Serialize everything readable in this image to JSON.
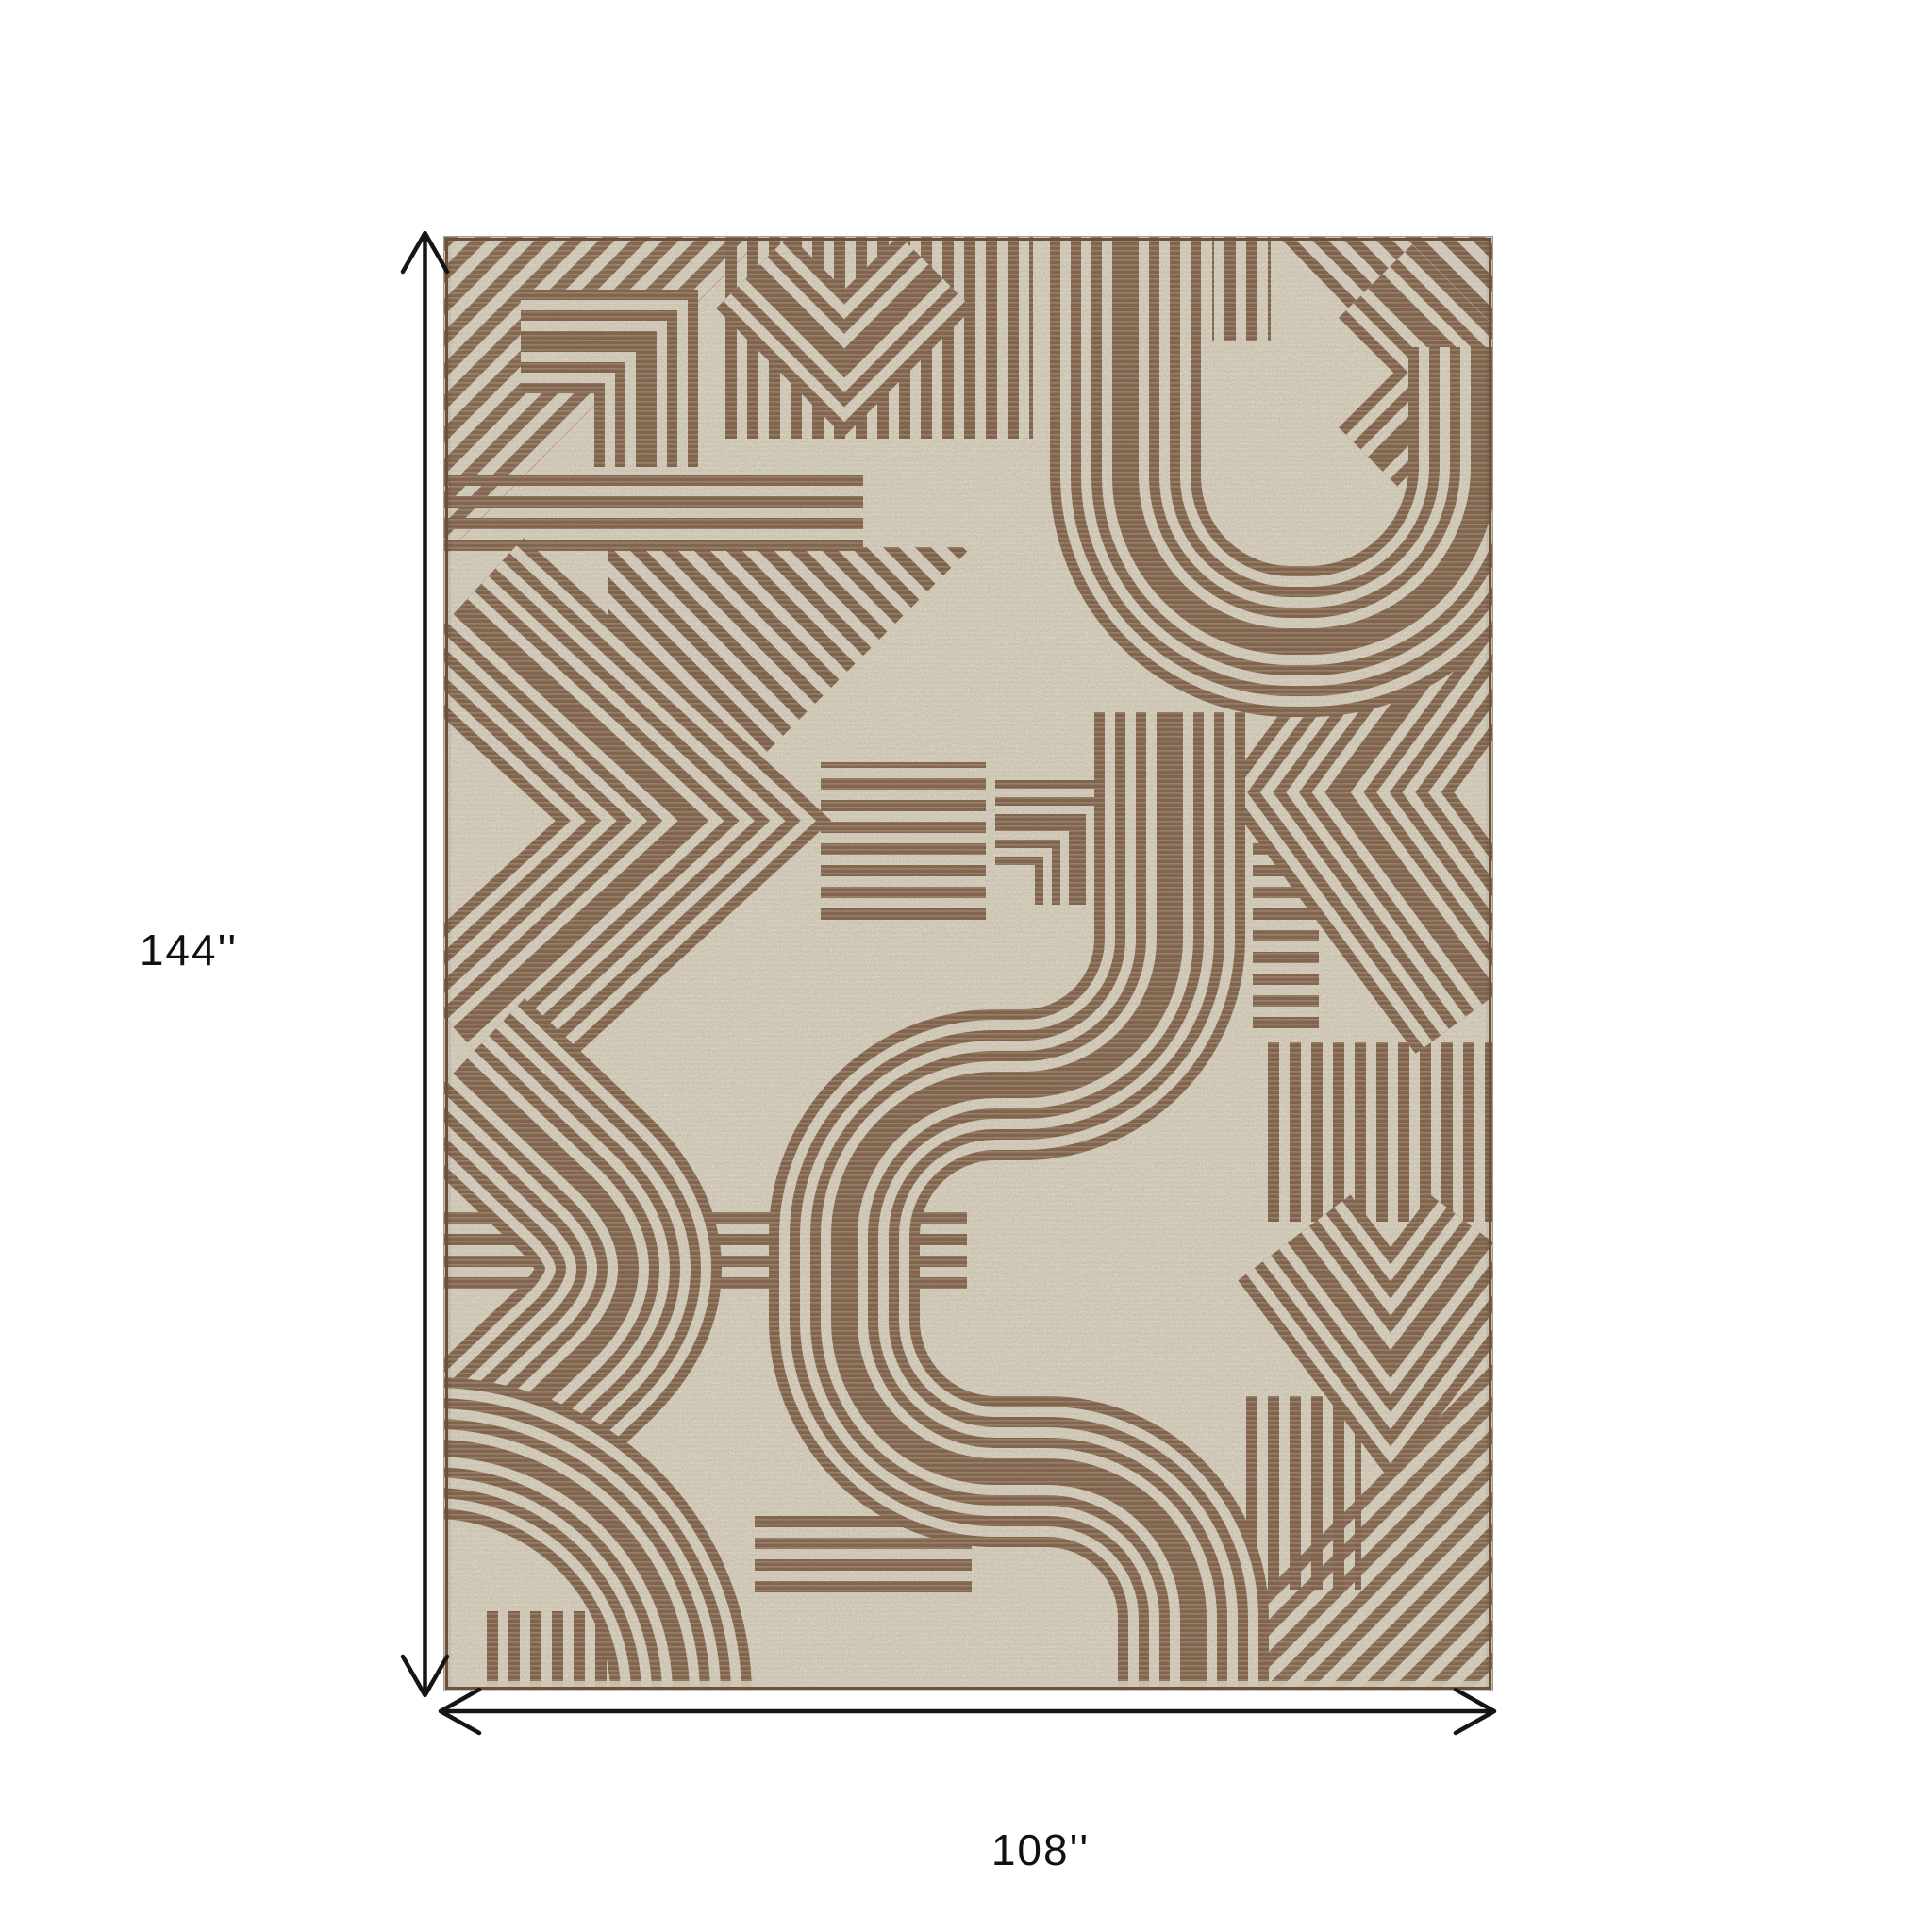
{
  "diagram": {
    "type": "product-dimension-diagram",
    "product": "geometric maze pattern area rug",
    "height_label": "144''",
    "width_label": "108''",
    "height_arrow": "vertical-double-headed-arrow",
    "width_arrow": "horizontal-double-headed-arrow",
    "colors": {
      "page_background": "#ffffff",
      "rug_background": "#d8d2c2",
      "rug_pattern_brown": "#7d604a",
      "rug_selvedge": "#6d513d",
      "dimension_lines": "#151515",
      "label_text": "#111111"
    }
  }
}
